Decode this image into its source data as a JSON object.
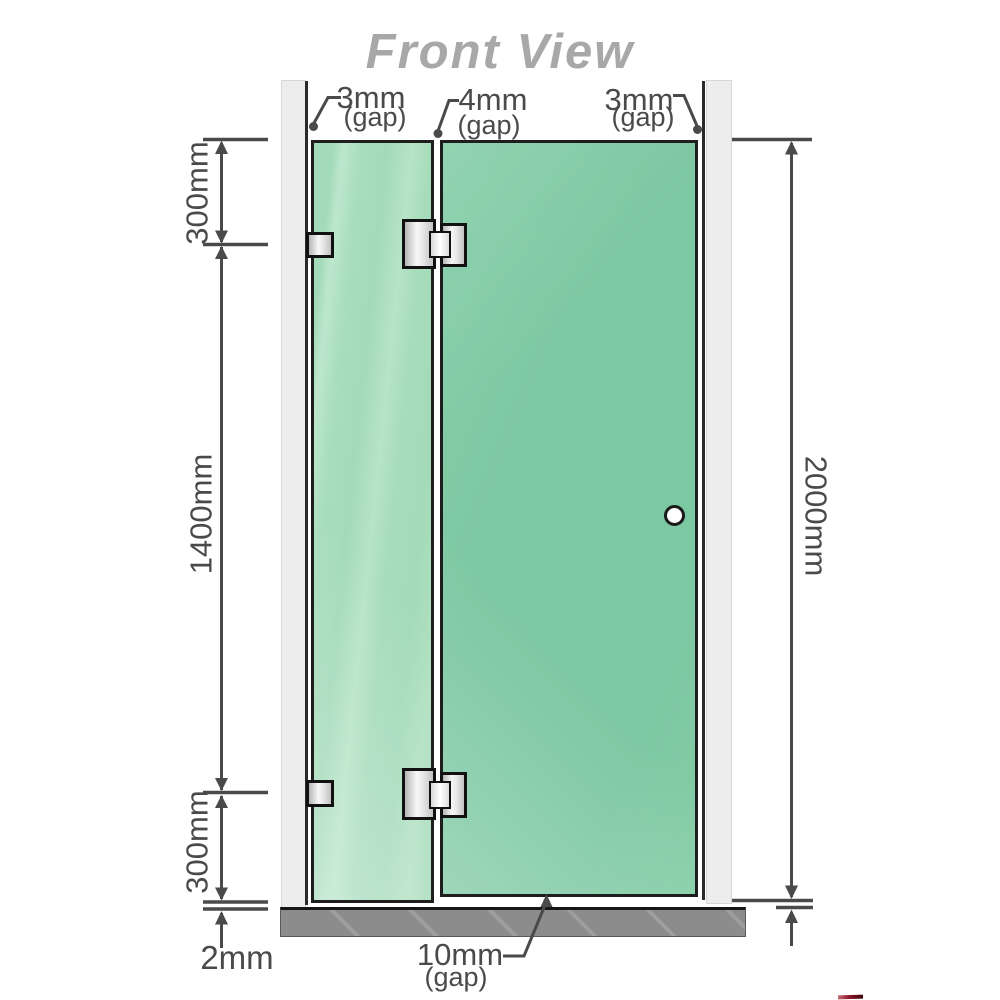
{
  "title": "Front View",
  "annotations": {
    "top_gaps": [
      {
        "value": "3mm",
        "suffix": "(gap)"
      },
      {
        "value": "4mm",
        "suffix": "(gap)"
      },
      {
        "value": "3mm",
        "suffix": "(gap)"
      }
    ],
    "left_dims": {
      "top": "300mm",
      "middle": "1400mm",
      "bottom": "300mm"
    },
    "bottom_left_dim": "2mm",
    "right_dim": "2000mm",
    "bottom_gap": {
      "value": "10mm",
      "suffix": "(gap)"
    }
  },
  "diagram": {
    "parts": [
      "left-wall-channel",
      "right-wall-channel",
      "fixed-glass-panel",
      "glass-door-panel",
      "wall-bracket-top",
      "wall-bracket-bottom",
      "glass-hinge-top",
      "glass-hinge-bottom",
      "door-knob",
      "floor-base"
    ],
    "colors": {
      "glass_fixed": "#a6dcbb",
      "glass_door": "#7cc8a2",
      "wall_channel": "#ededed",
      "floor_base": "#8c8c8c",
      "dimension_lines": "#4a4a4a",
      "title_text": "#a8a8a8",
      "hardware": "#e9e9e9"
    }
  }
}
